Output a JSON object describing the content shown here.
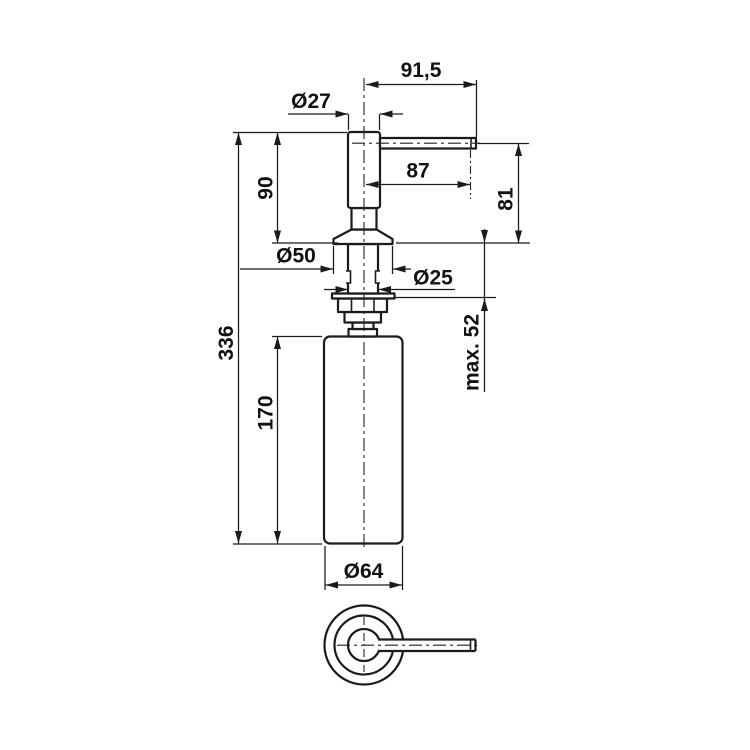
{
  "drawing": {
    "kind": "technical-dimension-drawing",
    "subject": "soap-dispenser",
    "dimensions": {
      "spout_reach_overall": "91,5",
      "head_diameter": "Ø27",
      "spout_reach_to_outlet": "87",
      "pump_height_above_counter": "90",
      "outlet_height_above_counter": "81",
      "overall_height": "336",
      "flange_diameter": "Ø50",
      "shank_diameter": "Ø25",
      "max_deck_thickness": "max. 52",
      "bottle_height": "170",
      "bottle_diameter": "Ø64"
    }
  }
}
